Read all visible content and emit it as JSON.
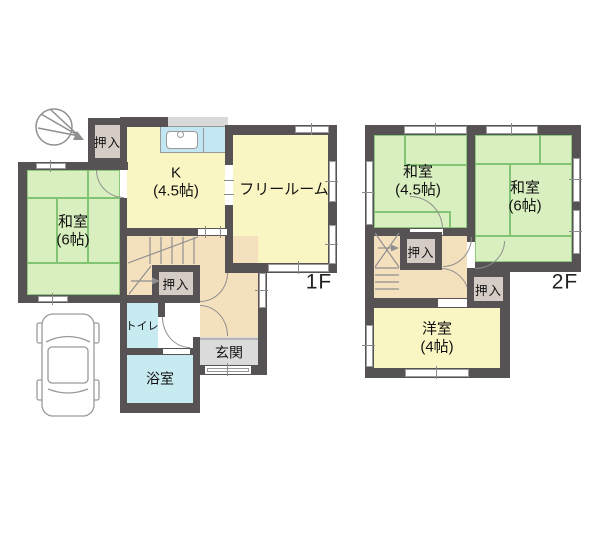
{
  "floor1": {
    "label": "1F",
    "rooms": {
      "closet_top": "押入",
      "kitchen_name": "K",
      "kitchen_size": "(4.5帖)",
      "free_room": "フリールーム",
      "washitsu_name": "和室",
      "washitsu_size": "(6帖)",
      "closet_mid": "押入",
      "toilet": "トイレ",
      "bath": "浴室",
      "entrance": "玄関"
    }
  },
  "floor2": {
    "label": "2F",
    "rooms": {
      "washitsu45_name": "和室",
      "washitsu45_size": "(4.5帖)",
      "washitsu6_name": "和室",
      "washitsu6_size": "(6帖)",
      "closet_a": "押入",
      "closet_b": "押入",
      "western_name": "洋室",
      "western_size": "(4帖)"
    }
  },
  "icons": {
    "north_arrow": "north-arrow",
    "car": "car-top-view",
    "stairs_1f": "stairs",
    "stairs_2f": "stairs",
    "kitchen_sink": "kitchen-sink"
  },
  "colors": {
    "wall": "#575355",
    "tatami_green": "#d9efbf",
    "room_yellow": "#faf6c3",
    "hall_tan": "#f4e0bd",
    "water_cyan": "#c8ebf1",
    "entrance_gray": "#dbdbdb",
    "closet_beige": "#d5ccc6"
  }
}
